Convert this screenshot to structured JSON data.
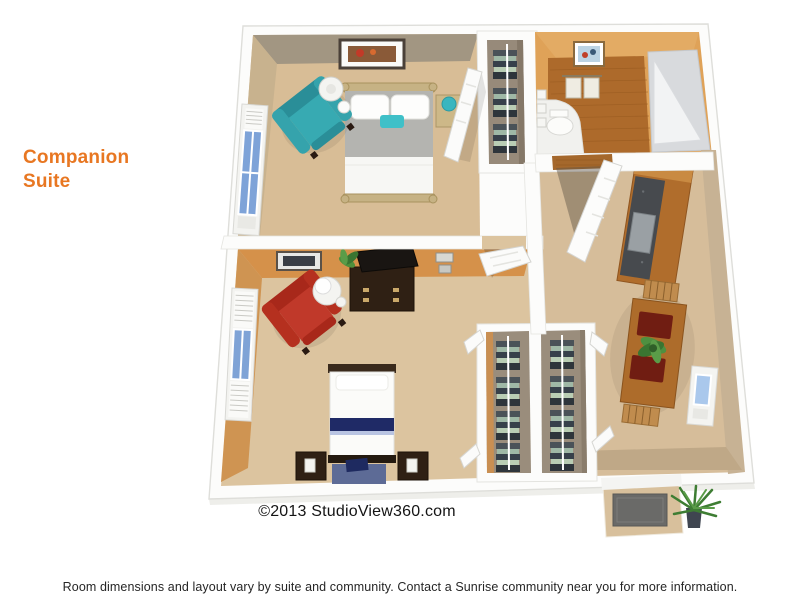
{
  "title": {
    "line1": "Companion",
    "line2": "Suite"
  },
  "copyright": "©2013 StudioView360.com",
  "disclaimer": "Room dimensions and layout vary by suite and community. Contact a Sunrise community near you for more information.",
  "colors": {
    "accent_orange": "#e87722",
    "text_dark": "#1c1c1c",
    "wall_white": "#fcfcfb",
    "bedroom1_wall": "#a29682",
    "bedroom1_floor": "#d8bd96",
    "bedroom2_wall": "#d5914a",
    "bedroom2_floor": "#dcc49f",
    "bathroom_wall": "#dfa258",
    "wood_floor": "#ad6a2b",
    "living_floor": "#d6bd9a",
    "teal_chair": "#35a3ac",
    "red_chair": "#b02d1c",
    "navy_bedding": "#1f2a66"
  },
  "floor_plan": {
    "type": "3d-floorplan-rendering",
    "suite_name": "Companion Suite",
    "rooms": [
      "bedroom-1",
      "bedroom-2",
      "bathroom",
      "walk-in-closet",
      "closet",
      "closet",
      "living-dining-area",
      "kitchenette",
      "entry-porch"
    ],
    "furniture": [
      "queen-bed",
      "teal-armchair",
      "floor-lamp",
      "nightstand",
      "framed-art",
      "double-bed",
      "red-armchair",
      "round-side-table",
      "dresser-with-tv",
      "dining-table-with-chairs",
      "kitchenette-counter",
      "toilet",
      "shower",
      "towel-rack",
      "doormat",
      "potted-plant"
    ]
  }
}
